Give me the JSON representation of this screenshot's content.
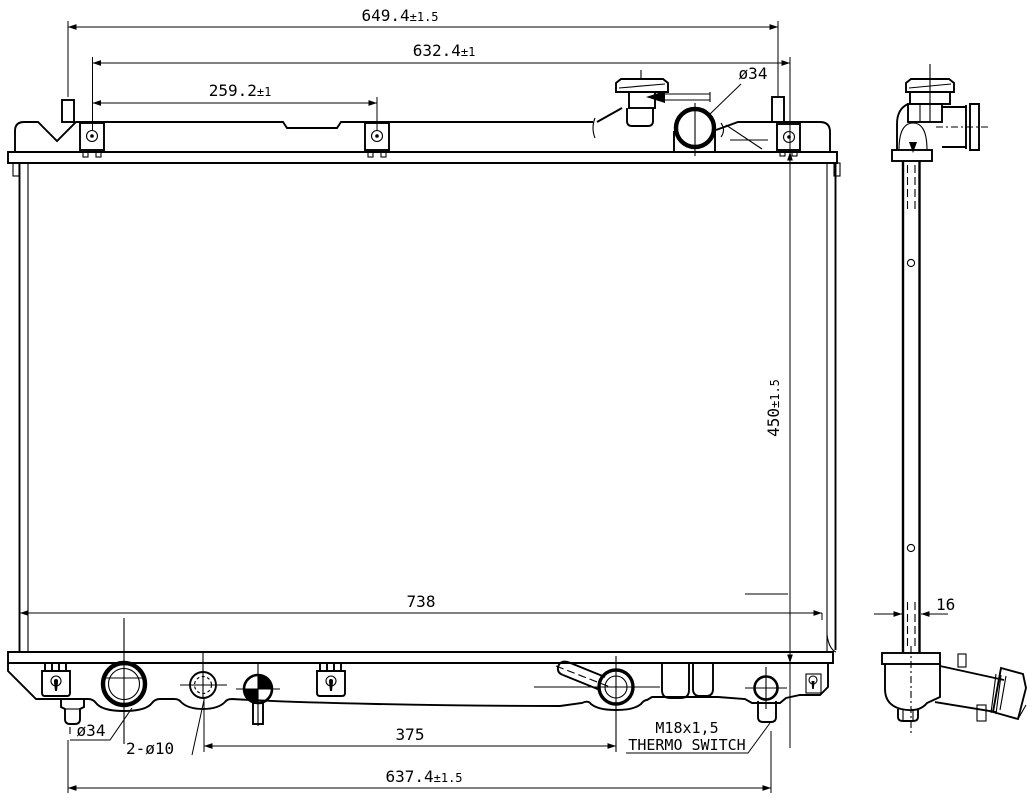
{
  "title": "Radiator engineering drawing",
  "colors": {
    "ink": "#000000",
    "paper": "#ffffff"
  },
  "dims": {
    "overall_width_top": {
      "value": "649.4",
      "tol": "±1.5"
    },
    "mount_span": {
      "value": "632.4",
      "tol": "±1"
    },
    "bracket_pitch": {
      "value": "259.2",
      "tol": "±1"
    },
    "inlet_dia": {
      "value": "ø34"
    },
    "core_height": {
      "value": "450",
      "tol": "±1.5"
    },
    "core_width": {
      "value": "738"
    },
    "outlet_dia": {
      "value": "ø34"
    },
    "drain_holes": {
      "value": "2-ø10"
    },
    "lower_pitch": {
      "value": "375"
    },
    "thermo_label_1": {
      "value": "M18x1,5"
    },
    "thermo_label_2": {
      "value": "THERMO SWITCH"
    },
    "overall_width_bottom": {
      "value": "637.4",
      "tol": "±1.5"
    },
    "core_thickness": {
      "value": "16"
    }
  }
}
